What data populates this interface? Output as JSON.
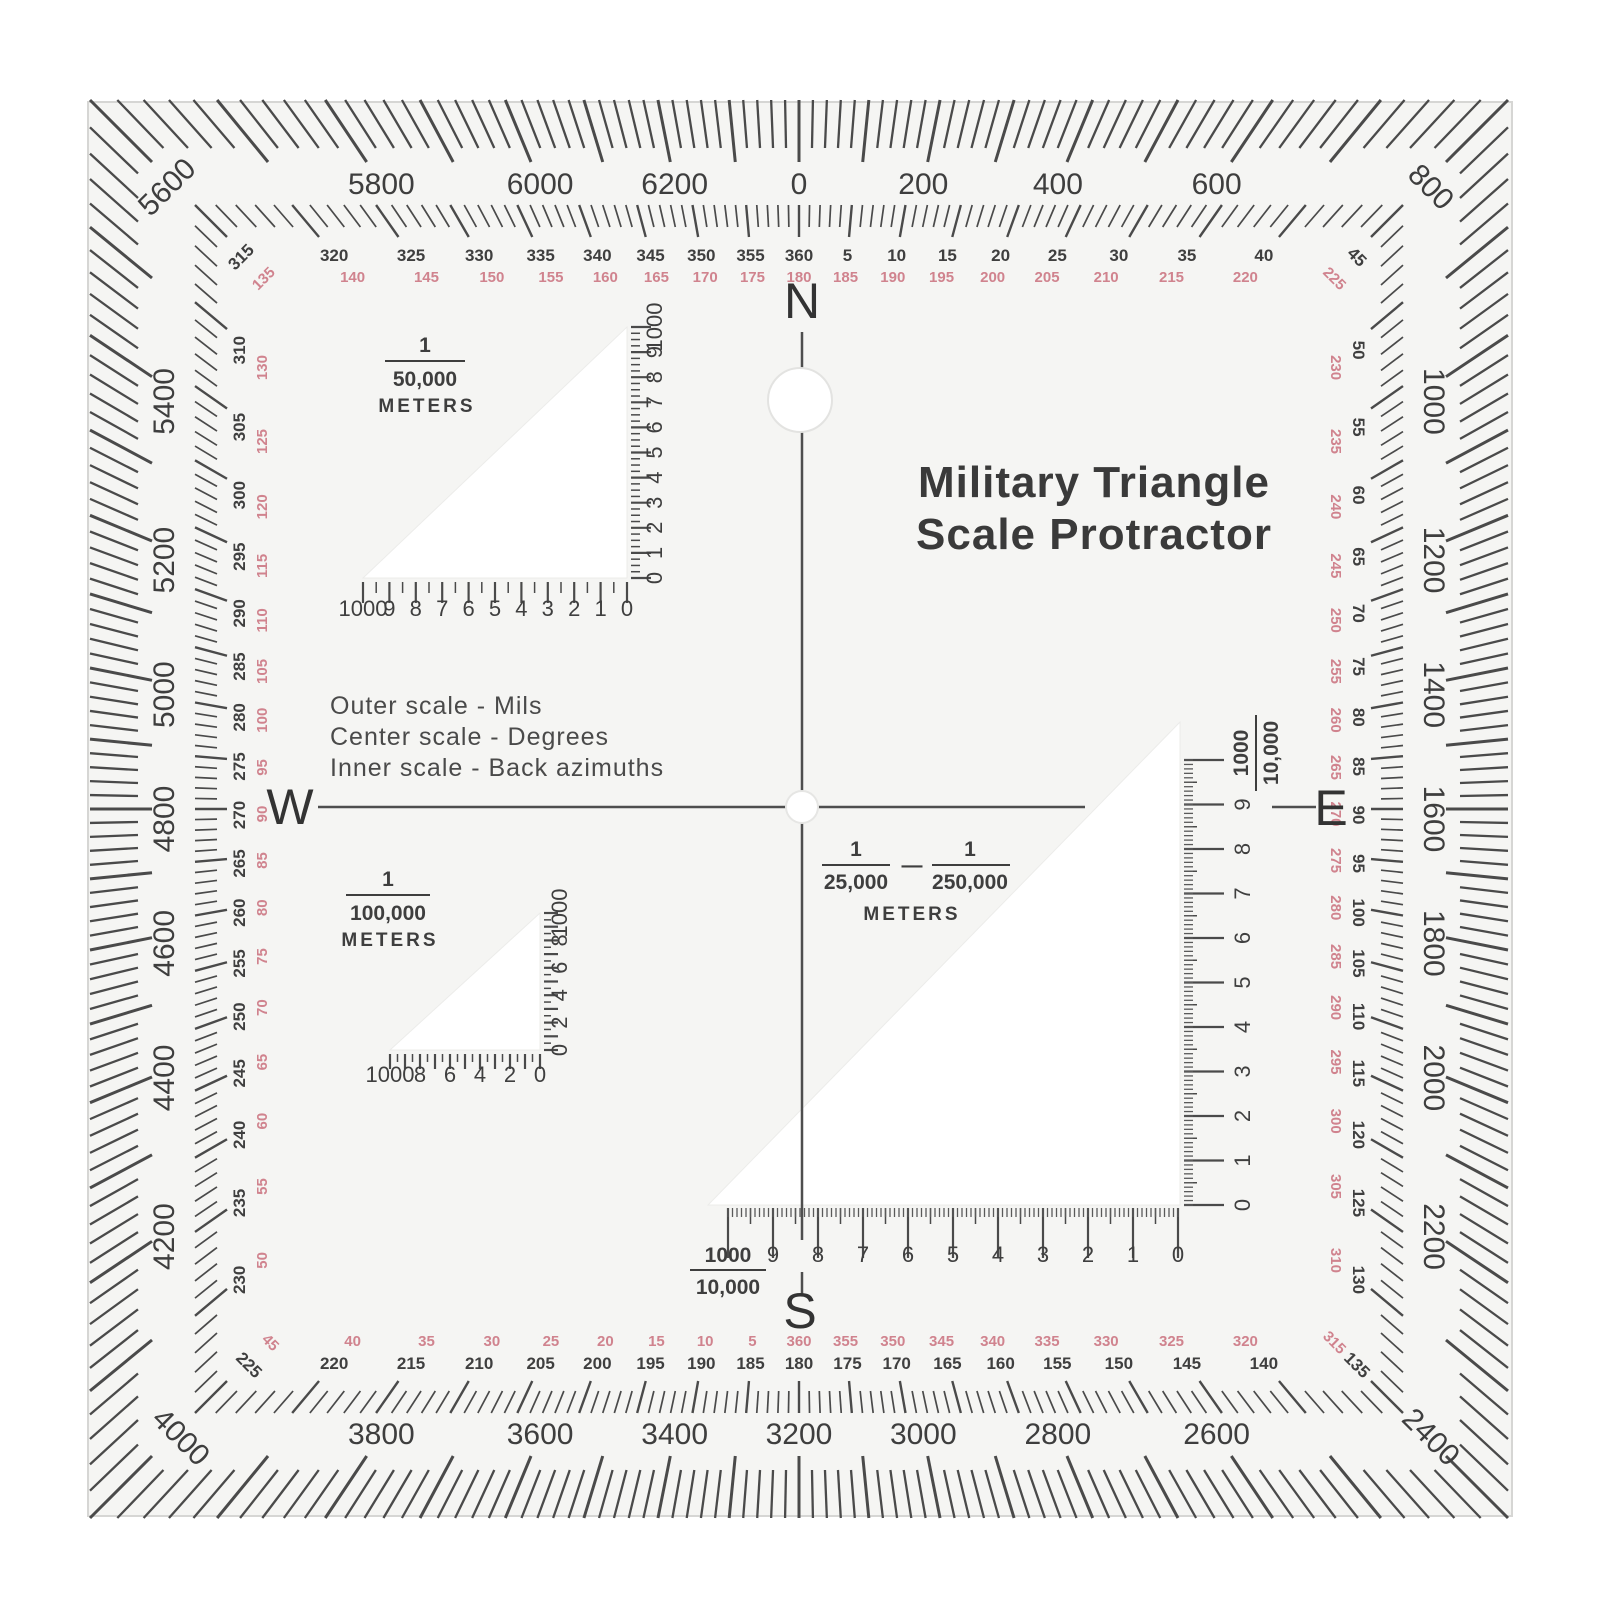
{
  "title": {
    "line1": "Military Triangle",
    "line2": "Scale Protractor"
  },
  "legend": {
    "line1": "Outer scale - Mils",
    "line2": "Center scale - Degrees",
    "line3": "Inner scale - Back azimuths"
  },
  "compass": {
    "north": "N",
    "south": "S",
    "east": "E",
    "west": "W"
  },
  "center_scale": {
    "num1": "1",
    "den1": "25,000",
    "separator": "—",
    "num2": "1",
    "den2": "250,000",
    "unit": "METERS"
  },
  "border": {
    "mils": {
      "full_circle": 6400,
      "minor_step": 20,
      "major_step": 100,
      "label_step": 200
    },
    "degrees": {
      "full_circle": 360,
      "minor_step": 1,
      "major_step": 5,
      "label_step": 5,
      "back_azimuth_offset": 180
    }
  },
  "triangles": {
    "t50k": {
      "num": "1",
      "den": "50,000",
      "unit": "METERS",
      "bottom_labels": [
        "1000",
        "9",
        "8",
        "7",
        "6",
        "5",
        "4",
        "3",
        "2",
        "1",
        "0"
      ],
      "right_labels": [
        "0",
        "1",
        "2",
        "3",
        "4",
        "5",
        "6",
        "7",
        "8",
        "9",
        "1000"
      ]
    },
    "t100k": {
      "num": "1",
      "den": "100,000",
      "unit": "METERS",
      "bottom_labels": [
        "1000",
        "8",
        "6",
        "4",
        "2",
        "0"
      ],
      "right_labels": [
        "0",
        "2",
        "4",
        "6",
        "8",
        "1000"
      ]
    },
    "t25k": {
      "frac_num": "1000",
      "frac_den": "10,000",
      "bottom_labels": [
        "9",
        "8",
        "7",
        "6",
        "5",
        "4",
        "3",
        "2",
        "1",
        "0"
      ],
      "right_labels": [
        "0",
        "1",
        "2",
        "3",
        "4",
        "5",
        "6",
        "7",
        "8",
        "9"
      ]
    }
  },
  "colors": {
    "ink": "#424242",
    "back_azimuth_red": "#d0838e",
    "plastic": "#f5f5f3",
    "triangle_white": "#ffffff"
  }
}
